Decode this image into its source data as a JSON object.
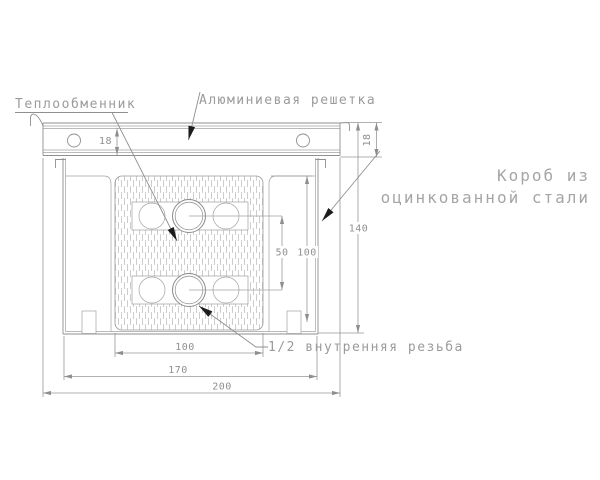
{
  "drawing": {
    "title": "convector-cross-section",
    "labels": {
      "heat_exchanger": "Теплообменник",
      "aluminum_grille": "Алюминиевая решетка",
      "galvanized_box_line1": "Короб из",
      "galvanized_box_line2": "оцинкованной стали",
      "thread": "1/2 внутренняя резьба"
    },
    "dimensions": {
      "grille_height_left": "18",
      "grille_height_right": "18",
      "box_height": "140",
      "inner_height": "100",
      "pipe_spacing": "50",
      "exchanger_width": "100",
      "box_width": "170",
      "grille_width": "200"
    },
    "colors": {
      "background": "#ffffff",
      "line": "#8f8f8f",
      "hatch": "#b8b8b8",
      "label_text": "#9b9b9b",
      "dim_text": "#8f8f8f",
      "leader_arrow": "#1c1c1c"
    }
  }
}
